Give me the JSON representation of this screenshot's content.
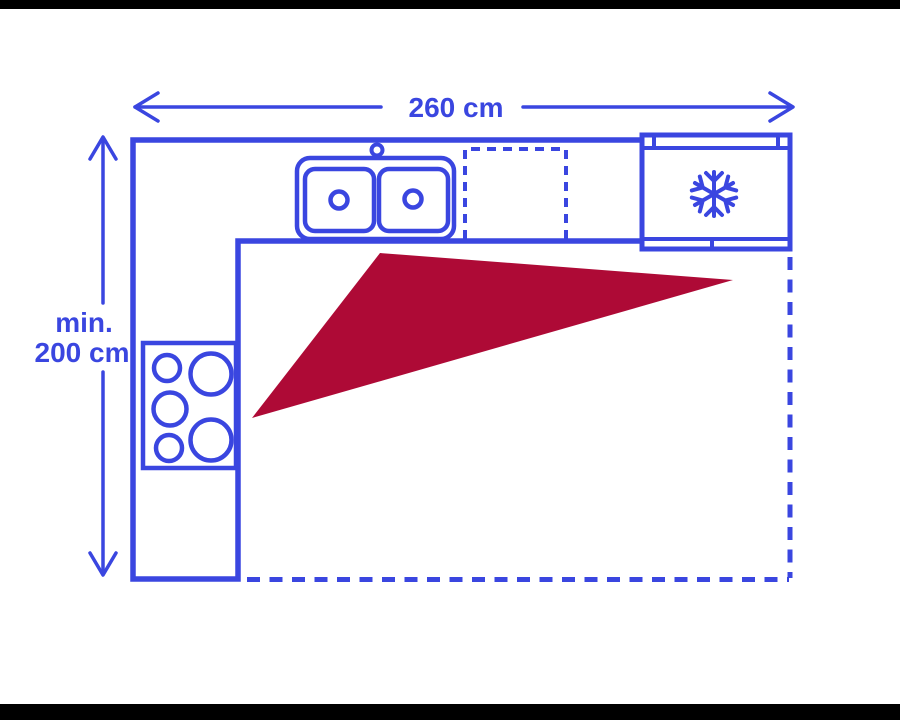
{
  "colors": {
    "line_blue": "#3A46E0",
    "work_triangle_red": "#AE0A36",
    "background": "#FFFFFF",
    "letterbox_black": "#000000"
  },
  "diagram": {
    "type": "kitchen-floor-plan-with-work-triangle",
    "width_dimension": {
      "label": "260 cm"
    },
    "height_dimension": {
      "label_line1": "min.",
      "label_line2": "200 cm"
    },
    "fixtures": {
      "refrigerator_icon": "snowflake-icon",
      "sink": "double-basin-sink",
      "cooktop": "five-burner-cooktop",
      "reserved_space": "dashed-appliance-space",
      "work_triangle": "kitchen-work-triangle"
    }
  }
}
